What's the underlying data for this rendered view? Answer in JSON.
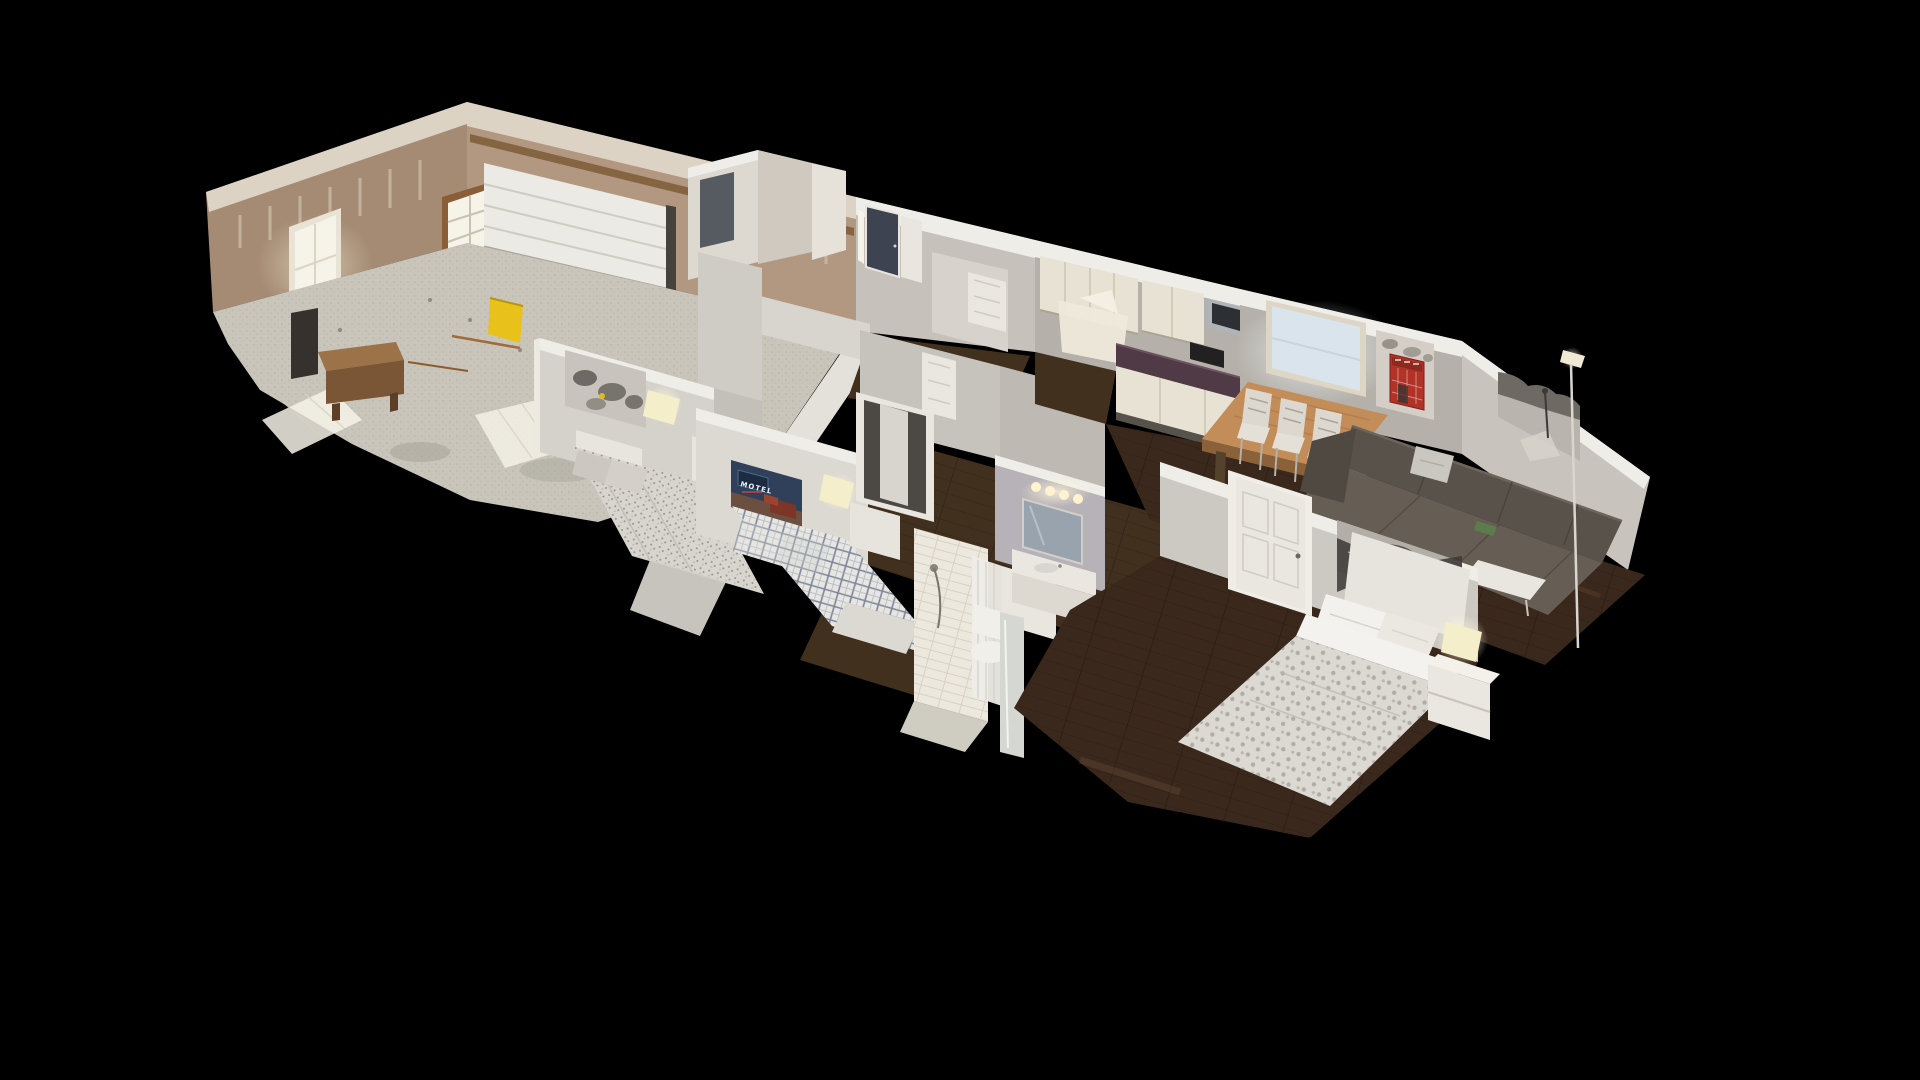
{
  "viewer": {
    "description": "3D dollhouse cutaway scan of a single-story house viewed from above at an angle on a pure black background",
    "view_mode": "dollhouse"
  },
  "palette": {
    "bg": "#000000",
    "drywall": "#a58b74",
    "drywall2": "#b29880",
    "drywallLight": "#ddd3c4",
    "wallGray": "#c6c2bb",
    "wallGray2": "#b5b1aa",
    "wallLight": "#e4e1da",
    "wallLight2": "#ccc8c2",
    "wallCap": "#efede8",
    "cabinet": "#e8e2d4",
    "counter": "#503a46",
    "concrete": "#c9c5bb",
    "floorWood": "#42301f",
    "floorWoodDark": "#3a281c",
    "garageDoor": "#eceae4",
    "doorWhite": "#eae7e1",
    "windowGlow": "#f6f3e8",
    "windowBlue": "#d9e4ec",
    "navyDoor": "#3d4350",
    "accentYellow": "#e8c21a",
    "accentRed": "#b23227",
    "tableWood": "#c28d59",
    "chairWhite": "#dcd8cf",
    "sofa": "#59524a",
    "sofaLight": "#665e54",
    "bedWhite": "#dcd9d3",
    "tile": "#ece8dd",
    "lavender": "#b7b1b8",
    "lampShade": "#f5eecb"
  },
  "scene": {
    "rooms": [
      {
        "name": "garage",
        "features": [
          "unfinished tan drywall with joint-compound stripes",
          "white garage door",
          "two bright windows",
          "yellow panel leaning on wall",
          "bare concrete floor with sunlight patches",
          "wood work bench",
          "dark shelf"
        ]
      },
      {
        "name": "entry",
        "features": [
          "dark navy front door",
          "bright sidelight",
          "white trim",
          "closet walls"
        ]
      },
      {
        "name": "kitchen",
        "features": [
          "cream upper cabinets",
          "stainless microwave",
          "black toaster",
          "dark plum countertop",
          "white lower cabinets",
          "dark wood floor"
        ]
      },
      {
        "name": "dining-area",
        "features": [
          "bright window",
          "light wood dining table",
          "white ladder-back chairs"
        ]
      },
      {
        "name": "living-room",
        "features": [
          "dark sectional sofa",
          "light gray throw pillow",
          "red London phone booth canvas",
          "black-and-white park canvas",
          "white coffee table",
          "thin floor lamp"
        ]
      },
      {
        "name": "bedroom-1",
        "features": [
          "black-and-white cityscape art",
          "gray floral bedding",
          "white headboard",
          "lit table lamp",
          "white nightstand"
        ]
      },
      {
        "name": "bedroom-2",
        "features": [
          "motel neon sign art",
          "blue-and-white plaid bedding",
          "lit table lamp",
          "white nightstand",
          "open closet",
          "white bench at foot of bed"
        ]
      },
      {
        "name": "master-bedroom",
        "features": [
          "black-and-white subway panorama art",
          "white damask bedding",
          "white headboard and pillows",
          "white nightstand with lit lamp",
          "white six-panel door"
        ]
      },
      {
        "name": "hall-bathroom",
        "features": [
          "lavender-gray walls",
          "vanity mirror",
          "four lit vanity bulbs",
          "white sink counter"
        ]
      },
      {
        "name": "master-bathroom",
        "features": [
          "white subway-tile shower",
          "handheld shower head",
          "white shower curtain",
          "toilet",
          "white dresser",
          "leaning mirror panel"
        ]
      },
      {
        "name": "hallway",
        "features": [
          "dark wood plank flooring",
          "maroon lit floor patch",
          "white interior doors"
        ]
      }
    ],
    "artworks": {
      "motel": {
        "name": "motel neon sign dusk scene",
        "sign_text": "MOTEL"
      },
      "red_phone_booth": {
        "name": "red London phone booth on grayscale street"
      },
      "park_bw": {
        "name": "black-and-white park with lamppost"
      },
      "subway_panorama": {
        "name": "black-and-white subway tunnel panorama"
      },
      "cityscape_bw": {
        "name": "black-and-white cityscape"
      }
    }
  }
}
